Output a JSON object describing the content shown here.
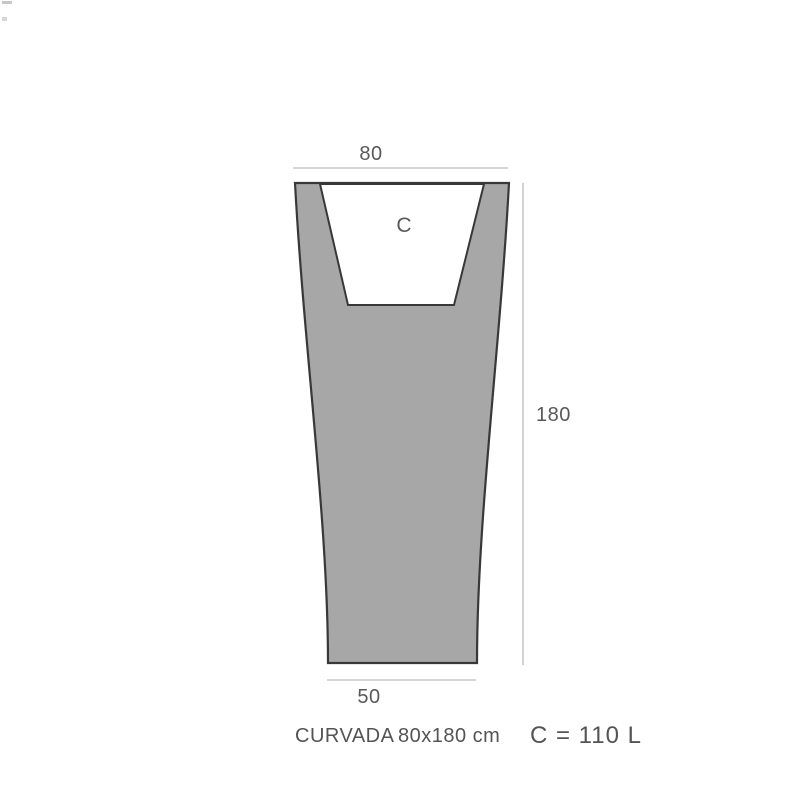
{
  "product": {
    "name": "CURVADA",
    "size": "80x180 cm",
    "capacity": "C = 110 L",
    "cavity_label": "C"
  },
  "dimensions": {
    "top_width": "80",
    "height": "180",
    "bottom_width": "50"
  },
  "colors": {
    "body_fill": "#a7a7a7",
    "cavity_fill": "#ffffff",
    "outline": "#383838",
    "dimension_line": "#bcbcbc",
    "dimension_text": "#59595b",
    "caption_text": "#545456"
  }
}
